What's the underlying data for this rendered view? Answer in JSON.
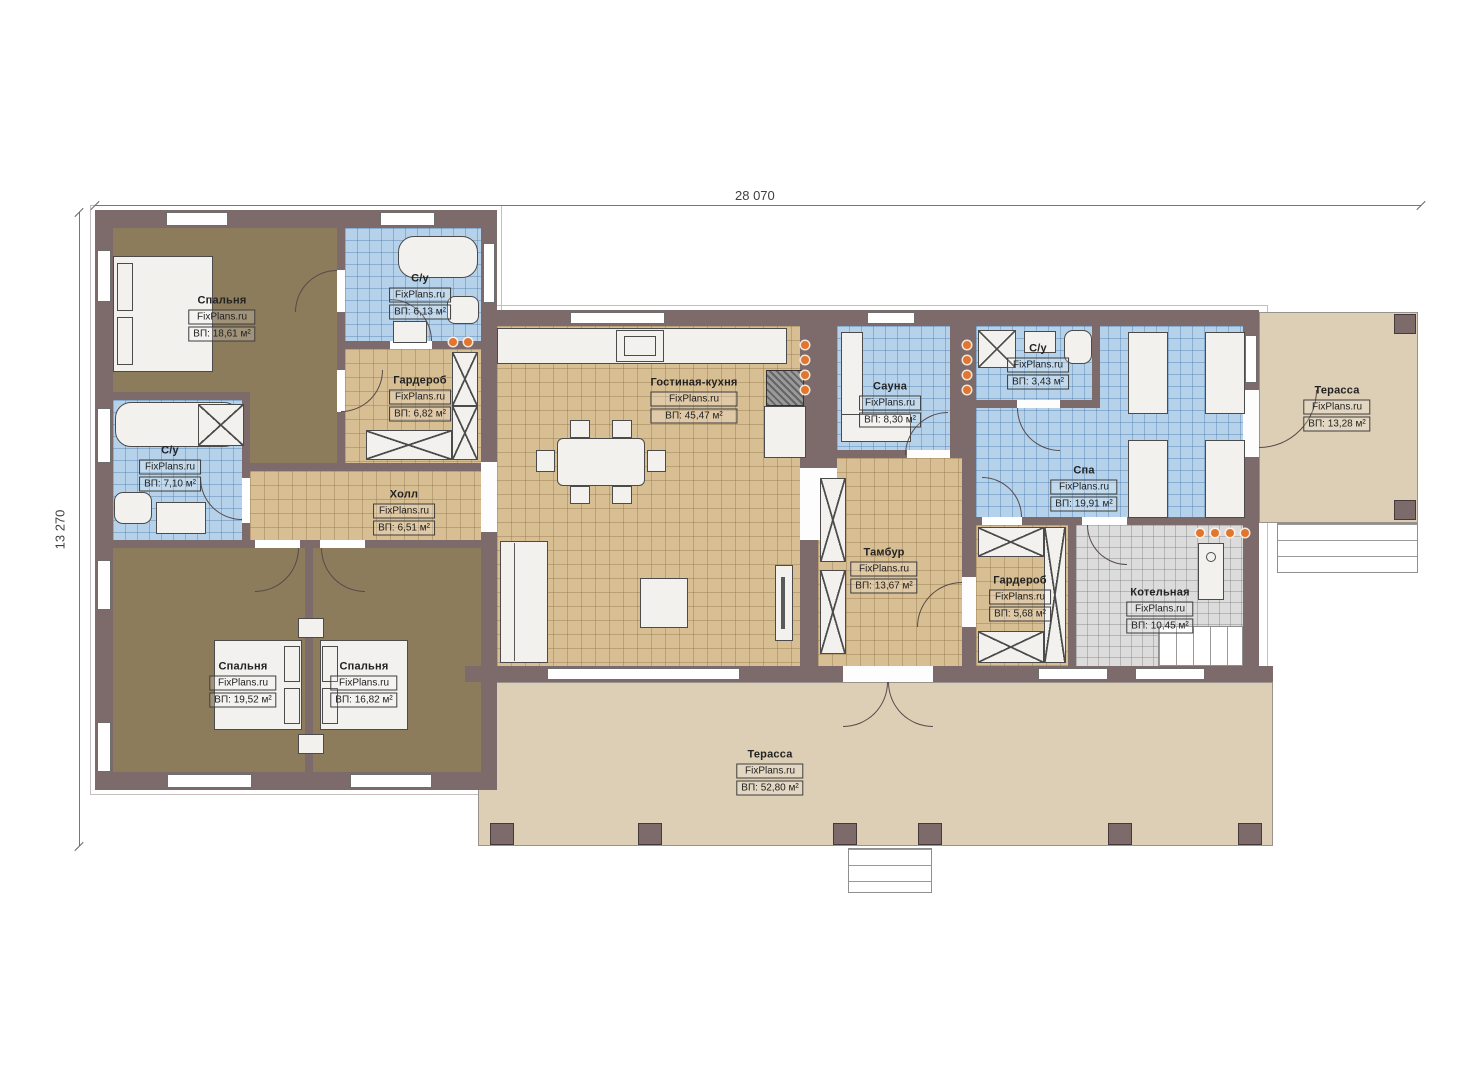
{
  "brand": "FixPlans.ru",
  "dimensions": {
    "width_label": "28 070",
    "height_label": "13 270"
  },
  "rooms": [
    {
      "id": "bedroom-1",
      "name": "Спальня",
      "area": "ВП: 18,61 м²"
    },
    {
      "id": "bathroom-1",
      "name": "С/у",
      "area": "ВП: 6,13 м²"
    },
    {
      "id": "wardrobe-1",
      "name": "Гардероб",
      "area": "ВП: 6,82 м²"
    },
    {
      "id": "bathroom-2",
      "name": "С/у",
      "area": "ВП: 7,10 м²"
    },
    {
      "id": "hall",
      "name": "Холл",
      "area": "ВП: 6,51 м²"
    },
    {
      "id": "bedroom-2",
      "name": "Спальня",
      "area": "ВП: 19,52 м²"
    },
    {
      "id": "bedroom-3",
      "name": "Спальня",
      "area": "ВП: 16,82 м²"
    },
    {
      "id": "living-kitchen",
      "name": "Гостиная-кухня",
      "area": "ВП: 45,47 м²"
    },
    {
      "id": "sauna",
      "name": "Сауна",
      "area": "ВП: 8,30 м²"
    },
    {
      "id": "vestibule",
      "name": "Тамбур",
      "area": "ВП: 13,67 м²"
    },
    {
      "id": "bathroom-3",
      "name": "С/у",
      "area": "ВП: 3,43 м²"
    },
    {
      "id": "spa",
      "name": "Спа",
      "area": "ВП: 19,91 м²"
    },
    {
      "id": "wardrobe-2",
      "name": "Гардероб",
      "area": "ВП: 5,68 м²"
    },
    {
      "id": "boiler-room",
      "name": "Котельная",
      "area": "ВП: 10,45 м²"
    },
    {
      "id": "terrace-right",
      "name": "Терасса",
      "area": "ВП: 13,28 м²"
    },
    {
      "id": "terrace-bottom",
      "name": "Терасса",
      "area": "ВП: 52,80 м²"
    }
  ]
}
